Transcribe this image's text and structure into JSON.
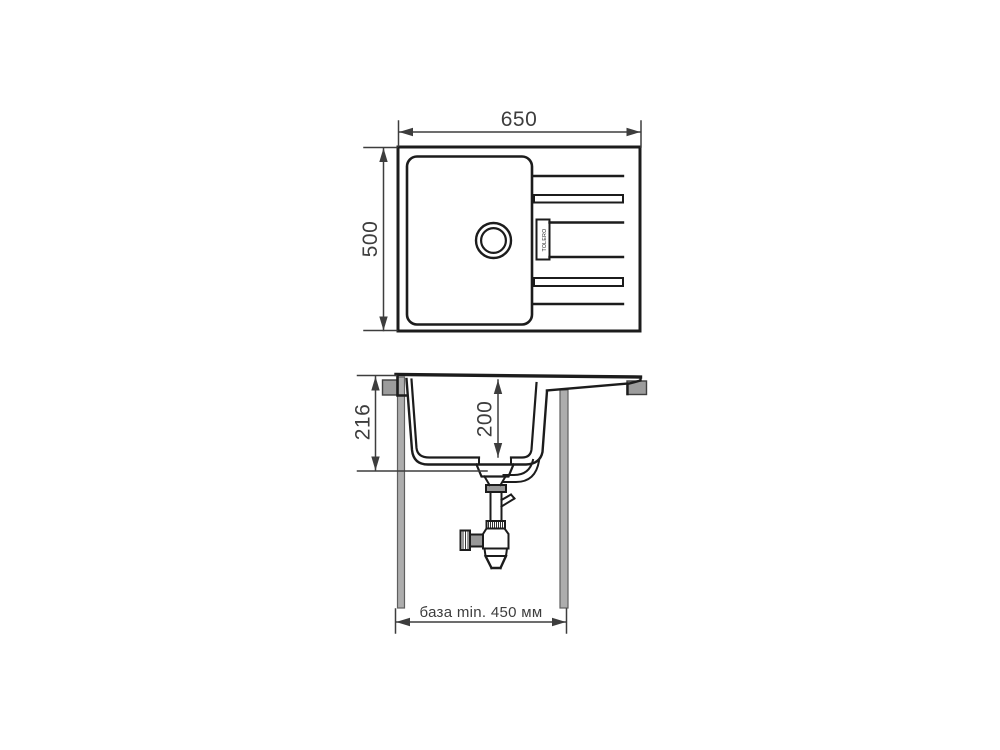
{
  "dimensions": {
    "top_view": {
      "width": "650",
      "height": "500"
    },
    "side_view": {
      "total_depth": "216",
      "bowl_depth": "200",
      "base": "база min. 450 мм"
    }
  },
  "brand_label": "TOLERO",
  "colors": {
    "line": "#1c1c1c",
    "dimension": "#3d3d3d",
    "panel_fill": "#adadad",
    "panel_edge": "#5f5f5f",
    "block_fill": "#9c9c9c",
    "block_edge": "#3f3f3f",
    "background": "#ffffff"
  }
}
